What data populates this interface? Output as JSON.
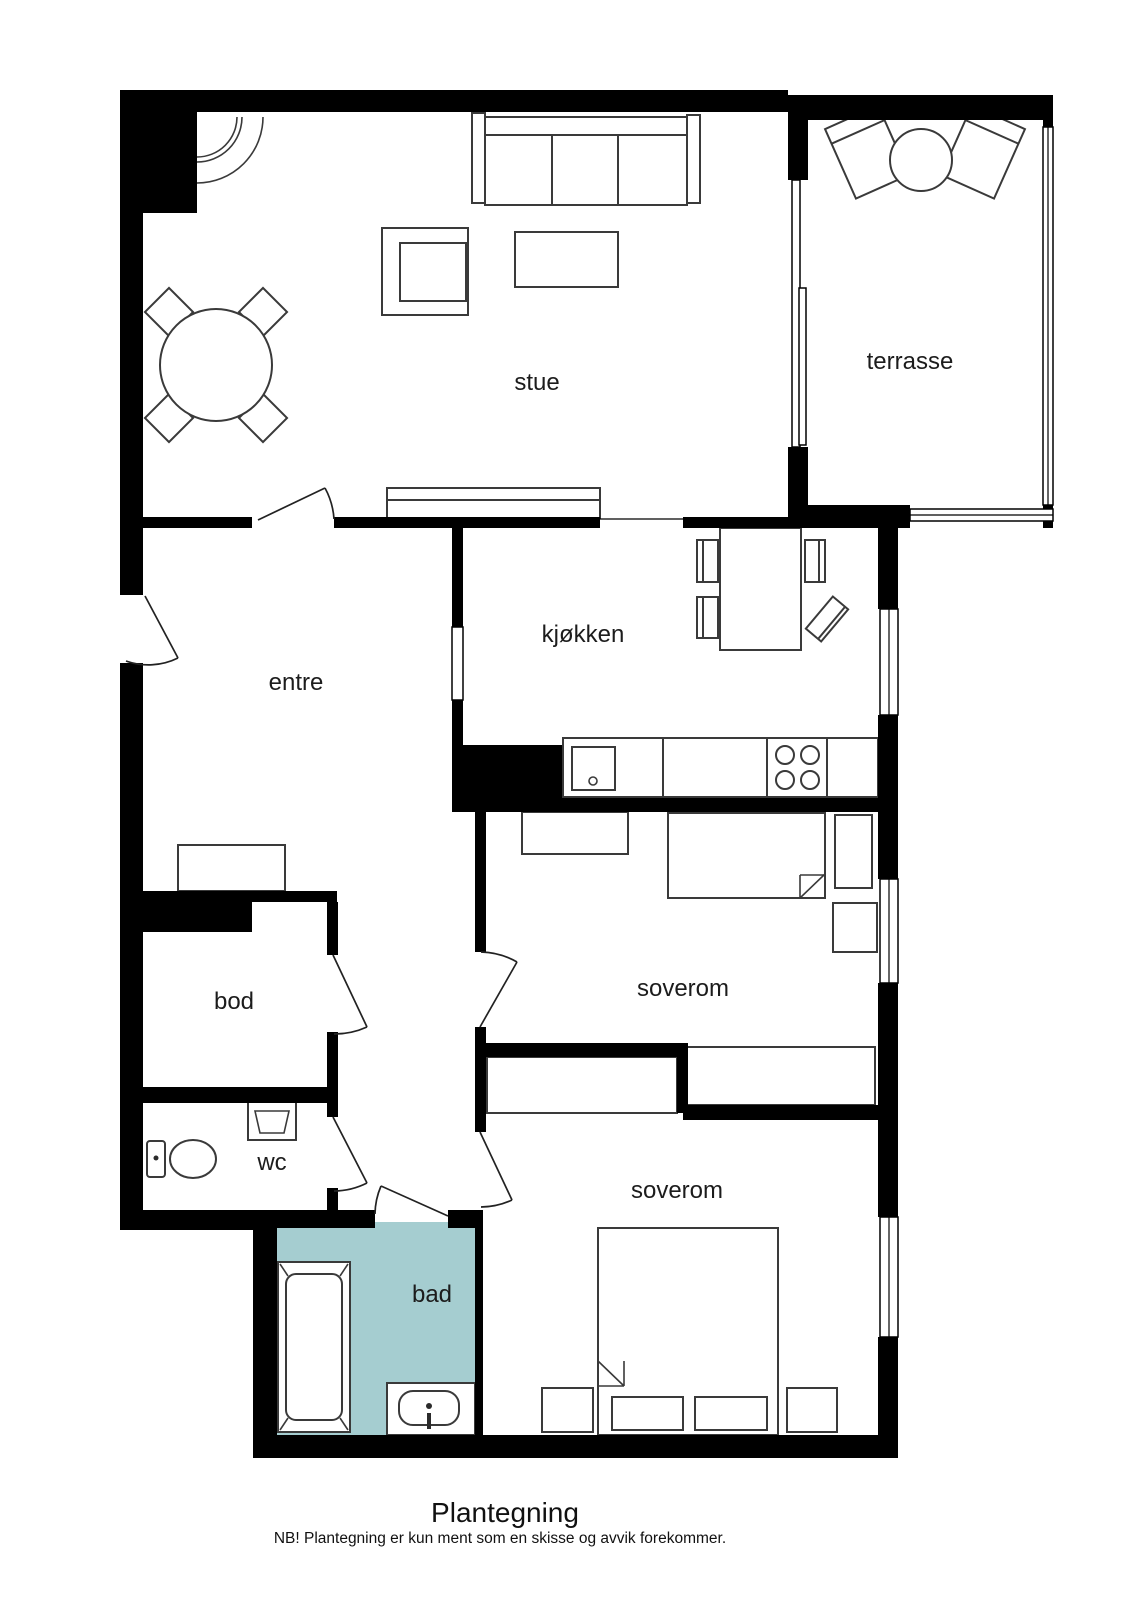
{
  "title": "Plantegning",
  "disclaimer": "NB! Plantegning er kun ment som en skisse og avvik forekommer.",
  "rooms": {
    "stue": {
      "label": "stue"
    },
    "terrasse": {
      "label": "terrasse"
    },
    "kjokken": {
      "label": "kjøkken"
    },
    "entre": {
      "label": "entre"
    },
    "bod": {
      "label": "bod"
    },
    "wc": {
      "label": "wc"
    },
    "bad": {
      "label": "bad"
    },
    "soverom_1": {
      "label": "soverom"
    },
    "soverom_2": {
      "label": "soverom"
    }
  },
  "colors": {
    "wall": "#000000",
    "bathroom_highlight": "#a5cdd0",
    "furniture_line": "#3a3a3a",
    "background": "#ffffff"
  }
}
